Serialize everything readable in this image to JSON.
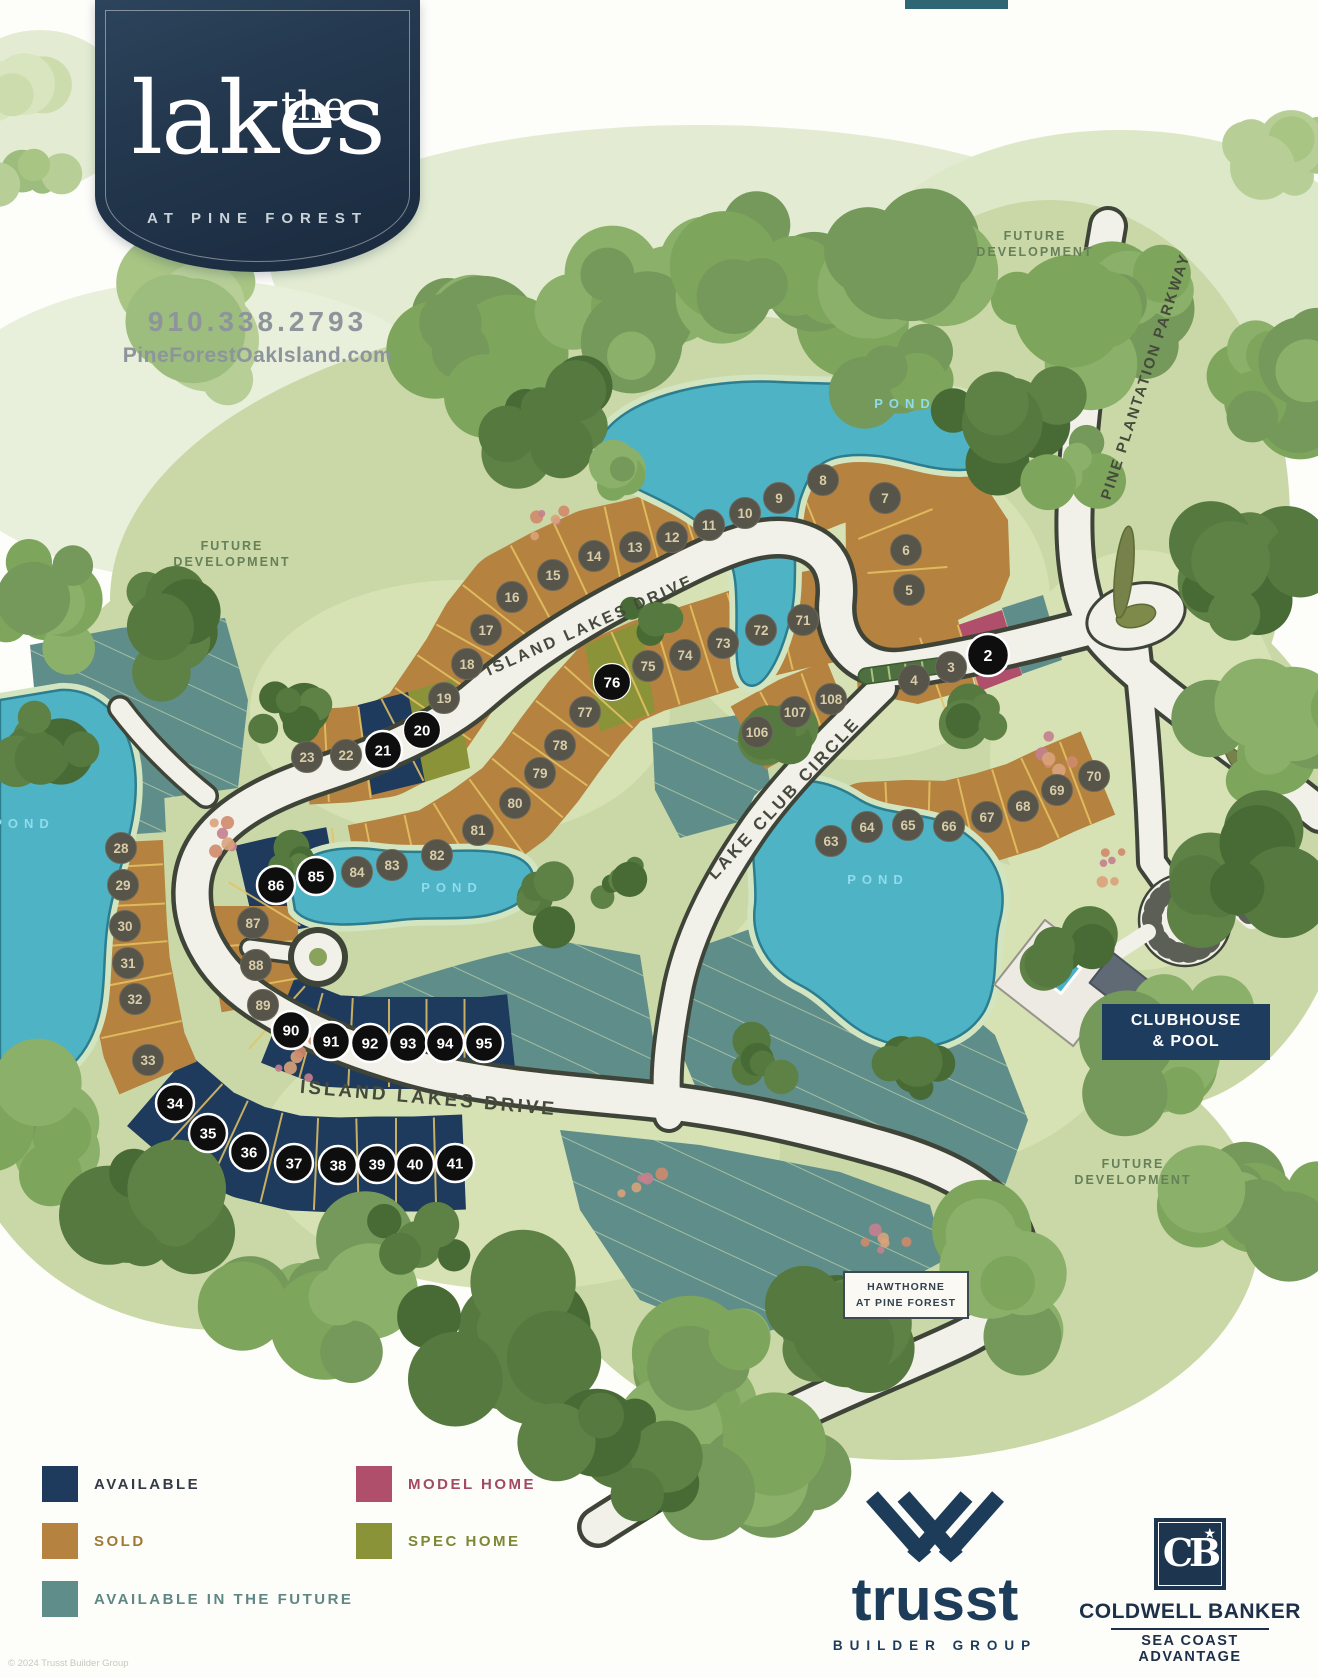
{
  "header": {
    "brand_top": "the",
    "brand_main": "lakes",
    "brand_sub": "AT PINE FOREST",
    "phone": "910.338.2793",
    "website": "PineForestOakIsland.com"
  },
  "legend": {
    "items": [
      {
        "label": "AVAILABLE",
        "color": "#1e3a5c",
        "text_color": "#343a46"
      },
      {
        "label": "SOLD",
        "color": "#b5823f",
        "text_color": "#a07a35"
      },
      {
        "label": "AVAILABLE IN THE FUTURE",
        "color": "#5f8e8a",
        "text_color": "#5f8783"
      },
      {
        "label": "MODEL HOME",
        "color": "#b04f6b",
        "text_color": "#a34a62"
      },
      {
        "label": "SPEC HOME",
        "color": "#8b9339",
        "text_color": "#7e8734"
      }
    ]
  },
  "map": {
    "colors": {
      "sold": "#b5823f",
      "available": "#1e3a5c",
      "future": "#5f8e8a",
      "model": "#b04f6b",
      "spec": "#8b9339",
      "pond": "#4fb3c6",
      "lot_line": "#e6c465"
    },
    "road_labels": [
      {
        "text": "ISLAND LAKES DRIVE",
        "x": 592,
        "y": 630,
        "rot": -24,
        "size": 16,
        "ls": 3
      },
      {
        "text": "ISLAND LAKES DRIVE",
        "x": 428,
        "y": 1104,
        "rot": 5,
        "size": 19,
        "ls": 3
      },
      {
        "text": "LAKE CLUB CIRCLE",
        "x": 788,
        "y": 802,
        "rot": -47,
        "size": 17,
        "ls": 3
      },
      {
        "text": "PINE PLANTATION PARKWAY",
        "x": 1150,
        "y": 378,
        "rot": -72,
        "size": 15,
        "ls": 2
      }
    ],
    "area_labels": [
      {
        "lines": [
          "FUTURE",
          "DEVELOPMENT"
        ],
        "x": 232,
        "y": 550
      },
      {
        "lines": [
          "FUTURE",
          "DEVELOPMENT"
        ],
        "x": 1035,
        "y": 240
      },
      {
        "lines": [
          "FUTURE",
          "DEVELOPMENT"
        ],
        "x": 1133,
        "y": 1168
      }
    ],
    "pond_labels": [
      {
        "text": "POND",
        "x": 905,
        "y": 408
      },
      {
        "text": "POND",
        "x": 452,
        "y": 892
      },
      {
        "text": "POND",
        "x": 878,
        "y": 884
      },
      {
        "text": "POND",
        "x": 24,
        "y": 828
      }
    ],
    "lots": {
      "sold": [
        [
          3,
          951,
          667
        ],
        [
          4,
          914,
          680
        ],
        [
          5,
          909,
          590
        ],
        [
          6,
          906,
          550
        ],
        [
          7,
          885,
          498
        ],
        [
          8,
          823,
          480
        ],
        [
          9,
          779,
          498
        ],
        [
          10,
          745,
          513
        ],
        [
          11,
          709,
          525
        ],
        [
          12,
          672,
          537
        ],
        [
          13,
          635,
          547
        ],
        [
          14,
          594,
          556
        ],
        [
          15,
          553,
          575
        ],
        [
          16,
          512,
          597
        ],
        [
          17,
          486,
          630
        ],
        [
          18,
          467,
          664
        ],
        [
          19,
          444,
          698
        ],
        [
          22,
          346,
          755
        ],
        [
          23,
          307,
          757
        ],
        [
          28,
          121,
          848
        ],
        [
          29,
          123,
          885
        ],
        [
          30,
          125,
          926
        ],
        [
          31,
          128,
          963
        ],
        [
          32,
          135,
          999
        ],
        [
          33,
          148,
          1060
        ],
        [
          63,
          831,
          841
        ],
        [
          64,
          867,
          827
        ],
        [
          65,
          908,
          825
        ],
        [
          66,
          949,
          826
        ],
        [
          67,
          987,
          817
        ],
        [
          68,
          1023,
          806
        ],
        [
          69,
          1057,
          790
        ],
        [
          70,
          1094,
          776
        ],
        [
          71,
          803,
          620
        ],
        [
          72,
          761,
          630
        ],
        [
          73,
          723,
          643
        ],
        [
          74,
          685,
          655
        ],
        [
          75,
          648,
          666
        ],
        [
          77,
          585,
          712
        ],
        [
          78,
          560,
          745
        ],
        [
          79,
          540,
          773
        ],
        [
          80,
          515,
          803
        ],
        [
          81,
          478,
          830
        ],
        [
          82,
          437,
          855
        ],
        [
          83,
          392,
          865
        ],
        [
          84,
          357,
          872
        ],
        [
          87,
          253,
          923
        ],
        [
          88,
          256,
          965
        ],
        [
          89,
          263,
          1005
        ],
        [
          106,
          757,
          732
        ],
        [
          107,
          795,
          712
        ],
        [
          108,
          831,
          699
        ]
      ],
      "available": [
        [
          21,
          383,
          750
        ],
        [
          34,
          175,
          1103
        ],
        [
          35,
          208,
          1133
        ],
        [
          36,
          249,
          1152
        ],
        [
          37,
          294,
          1163
        ],
        [
          38,
          338,
          1165
        ],
        [
          39,
          377,
          1164
        ],
        [
          40,
          415,
          1164
        ],
        [
          41,
          455,
          1163
        ],
        [
          85,
          316,
          876
        ],
        [
          86,
          276,
          885
        ],
        [
          90,
          291,
          1030
        ],
        [
          91,
          331,
          1041
        ],
        [
          92,
          370,
          1043
        ],
        [
          93,
          408,
          1043
        ],
        [
          94,
          445,
          1043
        ],
        [
          95,
          484,
          1043
        ]
      ],
      "spec": [
        [
          20,
          422,
          730
        ],
        [
          76,
          612,
          682
        ]
      ],
      "model": [
        [
          2,
          988,
          655
        ]
      ]
    },
    "bands": [
      {
        "lots": [
          8,
          9,
          10,
          11,
          12,
          13,
          14,
          15,
          16,
          17,
          18,
          19,
          20,
          21,
          22,
          23
        ],
        "half": 46
      },
      {
        "lots": [
          71,
          72,
          73,
          74,
          75,
          76,
          77,
          78,
          79,
          80,
          81,
          82,
          83,
          84,
          85,
          86
        ],
        "half": 46
      },
      {
        "lots": [
          86,
          87,
          88,
          89,
          90
        ],
        "half": 42
      },
      {
        "lots": [
          90,
          91,
          92,
          93,
          94,
          95
        ],
        "half": 44
      },
      {
        "lots": [
          34,
          35,
          36,
          37,
          38,
          39,
          40,
          41
        ],
        "half": 46
      },
      {
        "lots": [
          28,
          29,
          30,
          31,
          32,
          33
        ],
        "half": 41
      },
      {
        "lots": [
          63,
          64,
          65,
          66,
          67,
          68,
          69,
          70
        ],
        "half": 44
      },
      {
        "lots": [
          106,
          107,
          108
        ],
        "half": 34
      },
      {
        "lots": [
          7,
          6,
          5
        ],
        "half": 40
      },
      {
        "lots": [
          4,
          3,
          2
        ],
        "half": 38
      }
    ],
    "signs": {
      "clubhouse_line1": "CLUBHOUSE",
      "clubhouse_line2": "& POOL",
      "hawthorne_line1": "HAWTHORNE",
      "hawthorne_line2": "AT PINE FOREST"
    }
  },
  "footer": {
    "trusst_word": "trusst",
    "trusst_sub": "BUILDER GROUP",
    "cb_glyph": "CB",
    "cb_star": "★",
    "cb_name": "COLDWELL BANKER",
    "cb_sub1": "SEA COAST",
    "cb_sub2": "ADVANTAGE",
    "copyright": "© 2024 Trusst Builder Group"
  }
}
